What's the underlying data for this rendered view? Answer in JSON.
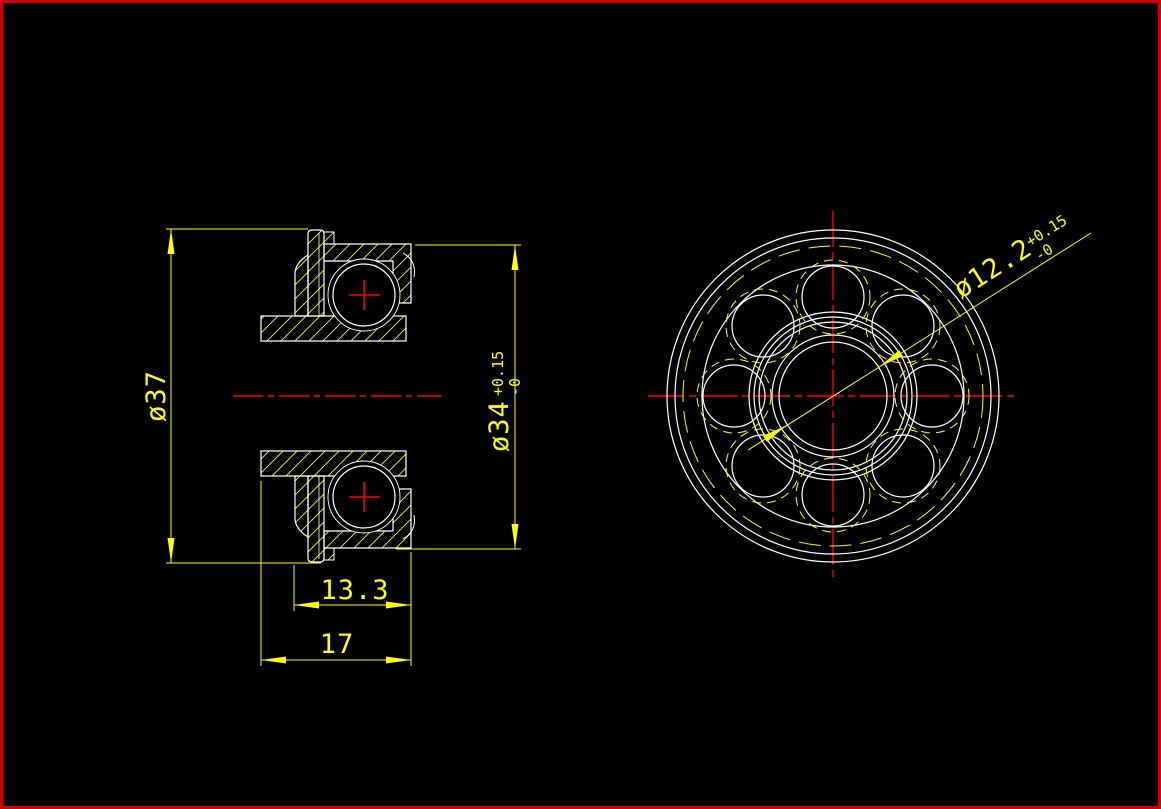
{
  "drawing": {
    "canvas_bg": "#000000",
    "frame_color": "#cf0000",
    "colors": {
      "outline": "#ffffff",
      "dimension": "#ffff00",
      "centerline": "#ff0000",
      "hatch": "#ffff00"
    },
    "section_view": {
      "label_flange_diameter": "ø37",
      "label_outer_diameter": "ø34",
      "outer_diameter_tol_upper": "+0.15",
      "outer_diameter_tol_lower": "-0",
      "label_inner_width": "13.3",
      "label_total_width": "17"
    },
    "front_view": {
      "label_bore_diameter": "ø12.2",
      "bore_tol_upper": "+0.15",
      "bore_tol_lower": "-0",
      "ball_count": 8
    }
  }
}
